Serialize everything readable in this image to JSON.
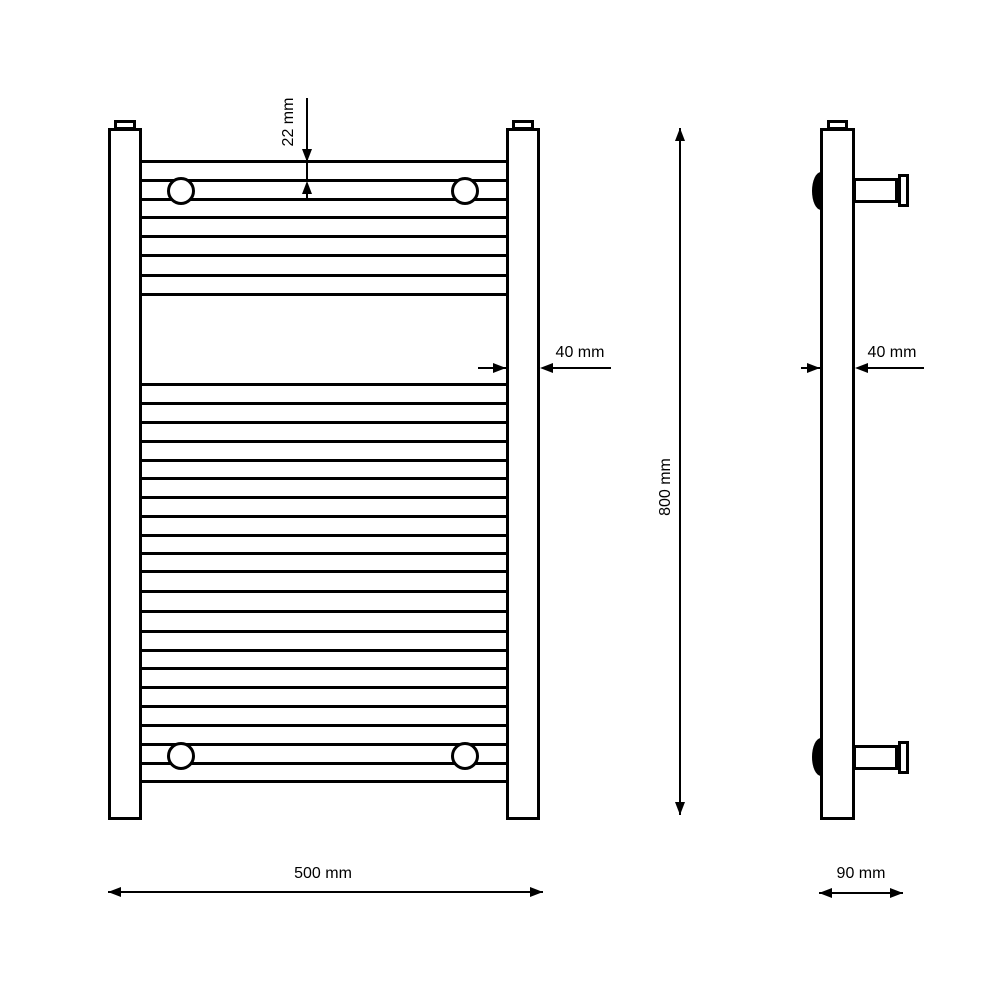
{
  "title": "Heated towel rail radiator - dimensioned technical drawing",
  "views": {
    "front": {
      "name": "front elevation",
      "labels": {
        "tube_diameter": "22 mm",
        "rail_width": "40 mm",
        "overall_width": "500 mm",
        "overall_height": "800 mm"
      },
      "rungs": {
        "top_group_lines": 8,
        "main_group_lines": 22
      },
      "wall_bracket_circles": 4
    },
    "side": {
      "name": "side elevation",
      "labels": {
        "rail_depth": "40 mm",
        "overall_depth": "90 mm"
      },
      "wall_brackets": 2
    }
  },
  "colors": {
    "line": "#000000",
    "background": "#ffffff"
  }
}
